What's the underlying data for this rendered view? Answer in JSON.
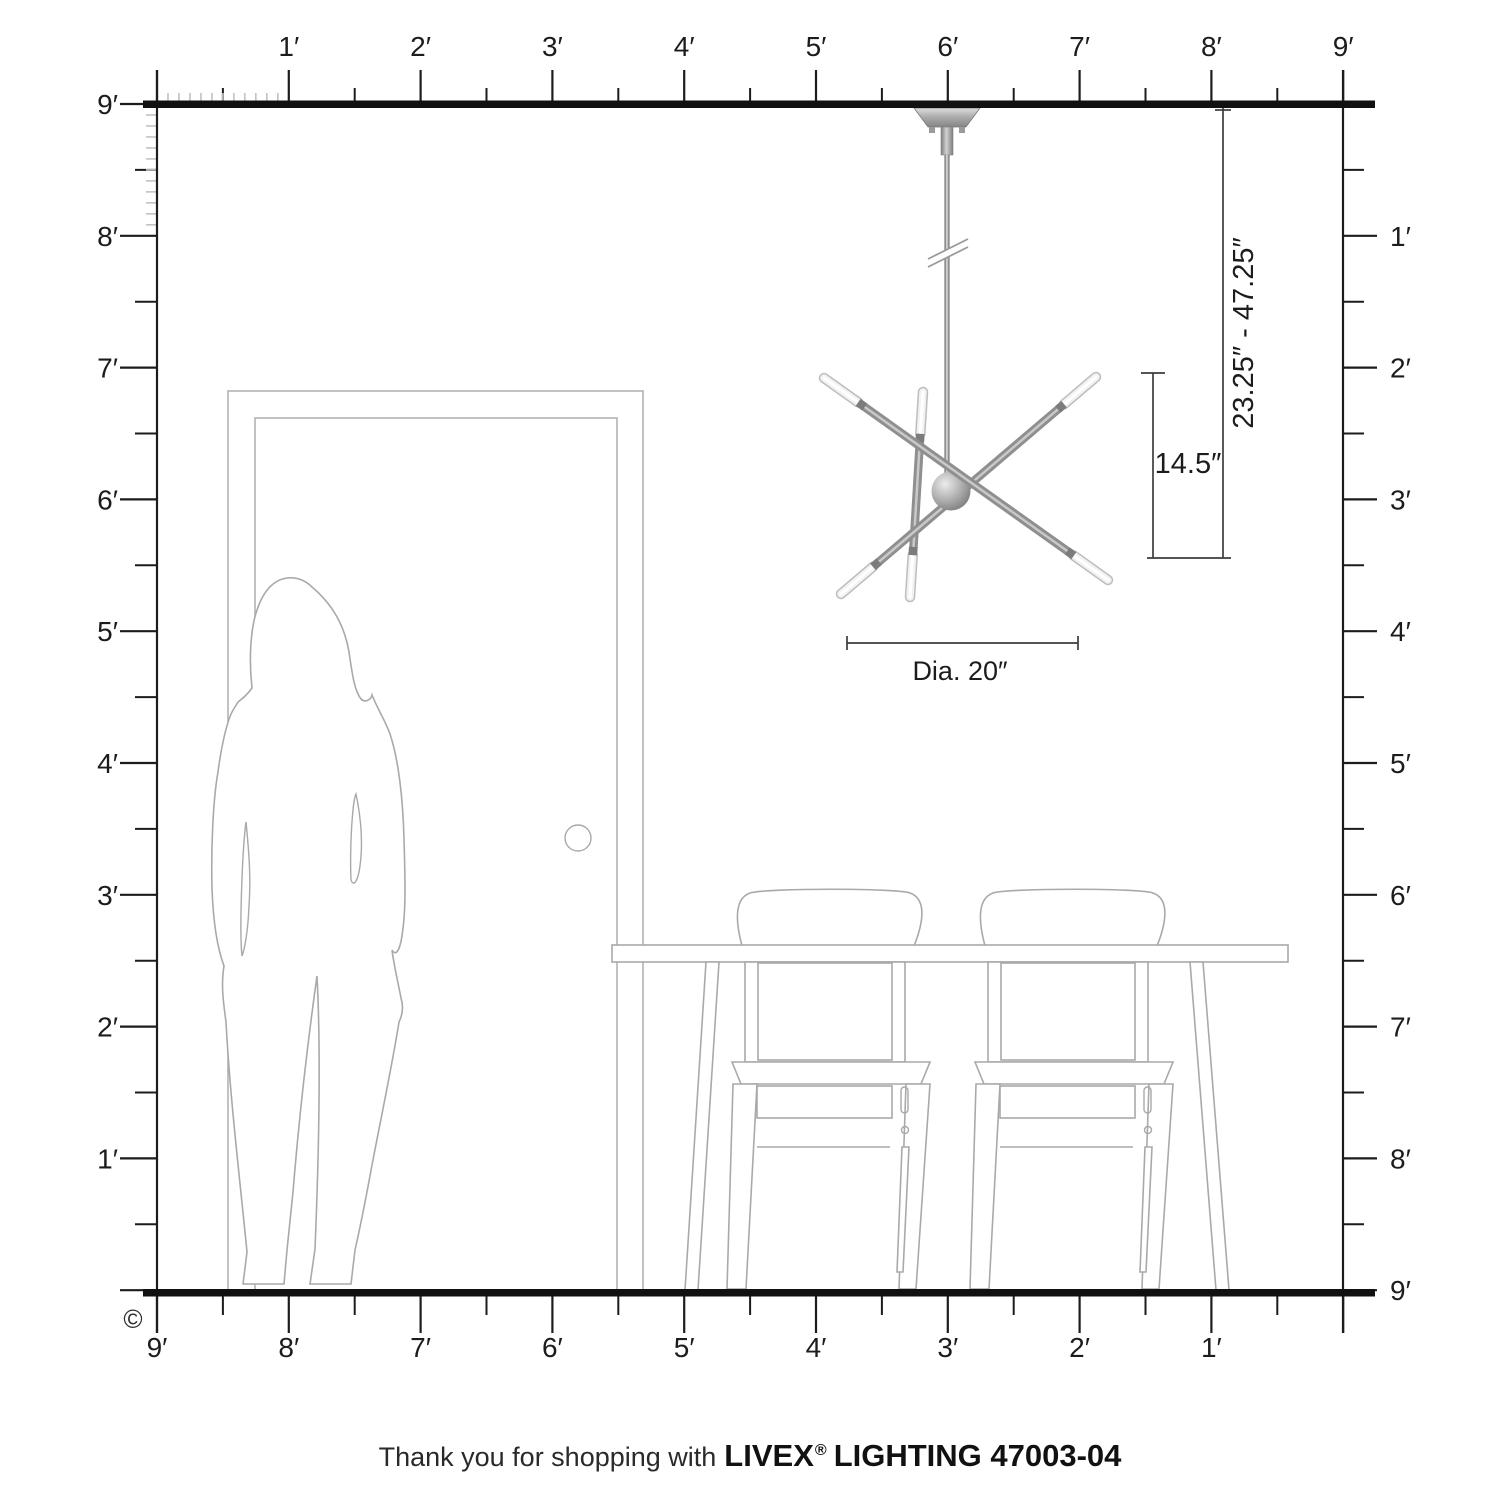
{
  "title": "Livex Lighting pendant scale diagram",
  "colors": {
    "ink": "#1c1c1c",
    "ruler_inch_tick": "#c2c2c2",
    "line_art": "#a9a9a9",
    "dimension": "#3d3d3d",
    "metal_dark": "#6f6f6f",
    "metal_mid": "#8f8f8f",
    "metal_light": "#d6d6d6",
    "bulb": "#f2f2f2"
  },
  "rulers": {
    "top_labels": [
      "1′",
      "2′",
      "3′",
      "4′",
      "5′",
      "6′",
      "7′",
      "8′",
      "9′"
    ],
    "left_labels": [
      "9′",
      "8′",
      "7′",
      "6′",
      "5′",
      "4′",
      "3′",
      "2′",
      "1′"
    ],
    "right_labels": [
      "1′",
      "2′",
      "3′",
      "4′",
      "5′",
      "6′",
      "7′",
      "8′",
      "9′"
    ],
    "bottom_labels": [
      "9′",
      "8′",
      "7′",
      "6′",
      "5′",
      "4′",
      "3′",
      "2′",
      "1′"
    ]
  },
  "dimensions": {
    "drop_range_label": "23.25″ - 47.25″",
    "fixture_height_label": "14.5″",
    "diameter_label": "Dia. 20″"
  },
  "copyright_symbol": "©",
  "footer": {
    "prefix": "Thank you for shopping with",
    "brand": "LIVEX",
    "registered": "®",
    "suffix": "LIGHTING 47003-04"
  }
}
